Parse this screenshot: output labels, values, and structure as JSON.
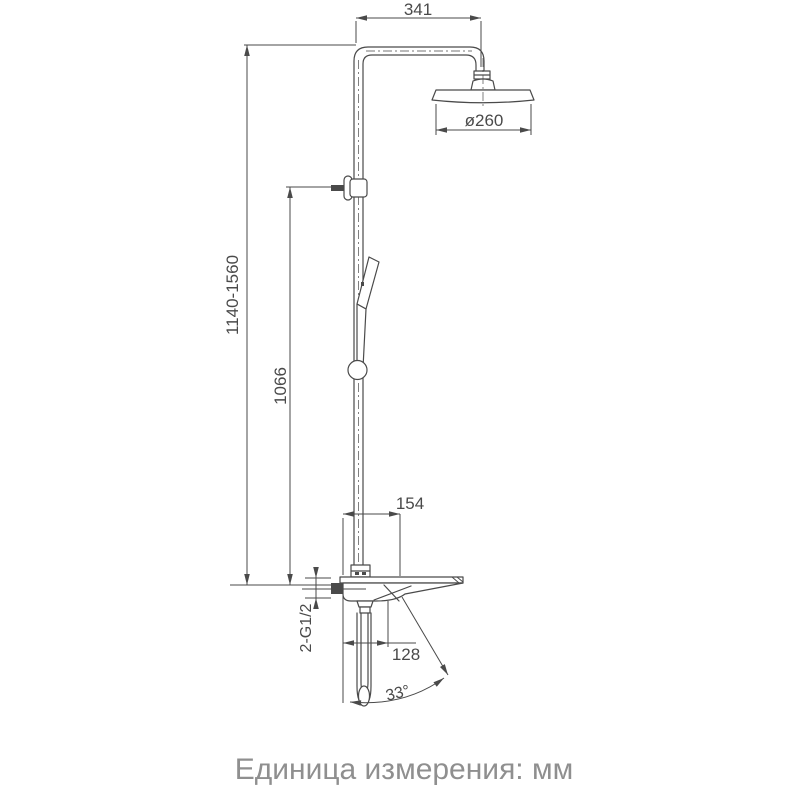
{
  "colors": {
    "line": "#4a4a4a",
    "caption": "#8f8f8f"
  },
  "diagram": {
    "dim_arm_length": "341",
    "dim_head_diameter": "ø260",
    "dim_total_height": "1140-1560",
    "dim_riser_height": "1066",
    "dim_deck_width": "154",
    "dim_spout_reach": "128",
    "label_inlet_thread": "2-G1/2",
    "dim_spout_angle": "33°"
  },
  "caption": "Единица измерения: мм"
}
